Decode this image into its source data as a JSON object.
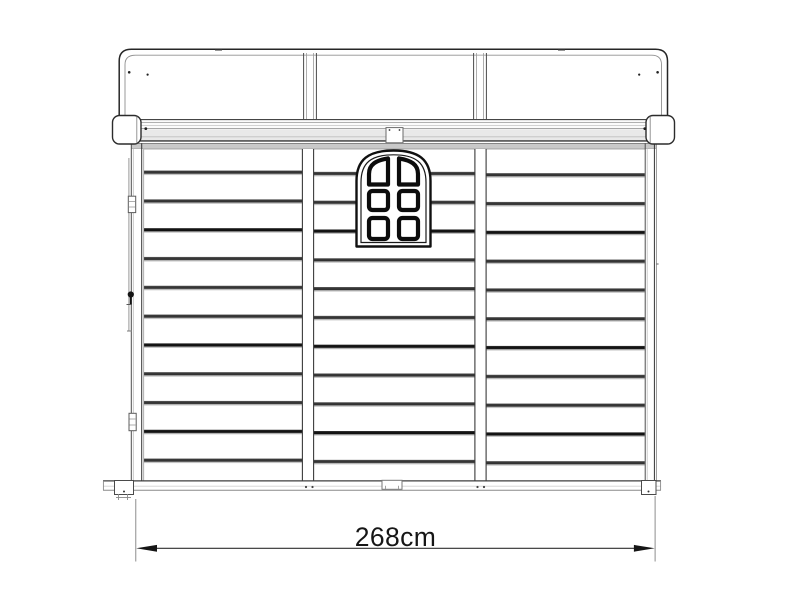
{
  "page": {
    "background_color": "#ffffff"
  },
  "diagram": {
    "subject": "Garden shed front elevation technical line drawing",
    "dimension": {
      "label": "268cm",
      "value": 268,
      "unit": "cm"
    },
    "features": {
      "roof_panels": 3,
      "wall_sections": 3,
      "cladding_lines_per_section": 11,
      "window": {
        "style": "arched",
        "pane_rows": 3,
        "pane_columns": 2,
        "pane_count": 6
      },
      "hardware": [
        "top-hinge",
        "latch",
        "bottom-hinge"
      ],
      "base_feet": 4
    },
    "colors": {
      "background": "#ffffff",
      "line_dark": "#1f1f1f",
      "line_medium": "#6e6e6e",
      "line_light": "#c4c4c4",
      "shadow_band": "#c9c9c9",
      "cladding_dark": "#303030",
      "dimension_text": "#161616"
    }
  }
}
